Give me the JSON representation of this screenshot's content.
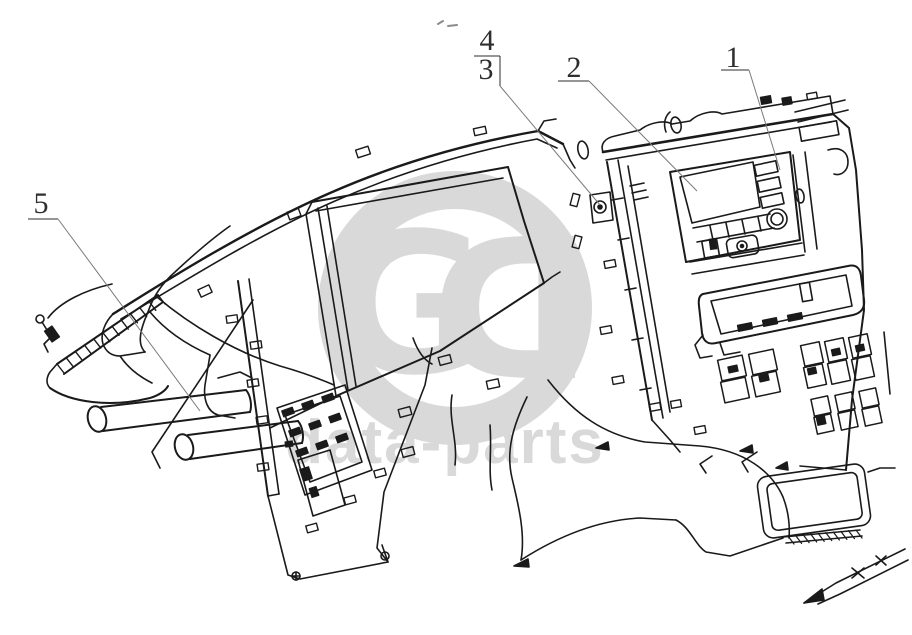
{
  "figure": {
    "type": "exploded-parts-line-diagram",
    "subject": "vehicle dashboard / instrument panel assembly",
    "background_color": "#ffffff",
    "line_color": "#1a1a1a",
    "leader_line_color": "#7a7a7a"
  },
  "callouts": {
    "c1": {
      "label": "1"
    },
    "c2": {
      "label": "2"
    },
    "c3": {
      "label": "3"
    },
    "c4": {
      "label": "4"
    },
    "c5": {
      "label": "5"
    }
  },
  "watermark": {
    "color": "#d9d9d9",
    "monogram_left": "G",
    "monogram_right": "D",
    "wordmark": "data-parts"
  }
}
